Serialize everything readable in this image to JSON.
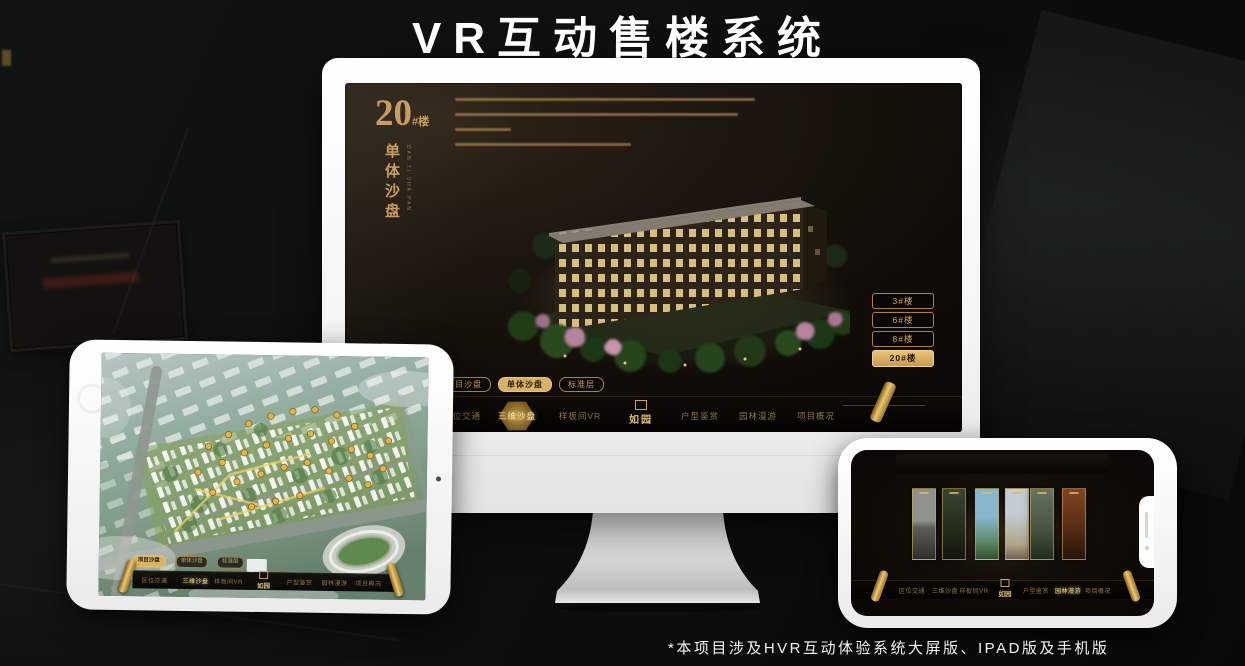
{
  "header": {
    "title": "VR互动售楼系统"
  },
  "footer": {
    "note": "*本项目涉及HVR互动体验系统大屏版、IPAD版及手机版"
  },
  "brand": {
    "logo_text": "如园"
  },
  "palette": {
    "gold": "#c9a05c",
    "gold_selected": "#d9b266",
    "screen_brown": "#1c1510",
    "device_white": "#f5f5f5"
  },
  "menu": {
    "items": [
      {
        "label": "区位交通"
      },
      {
        "label": "三维沙盘"
      },
      {
        "label": "样板间VR"
      },
      {
        "label": "户型鉴赏"
      },
      {
        "label": "园林漫游"
      },
      {
        "label": "项目概况"
      }
    ]
  },
  "monitor": {
    "screen_title": {
      "number": "20",
      "suffix": "#楼",
      "vertical": "单体沙盘",
      "vertical_en": "DAN TI SHA PAN"
    },
    "floor_buttons": [
      {
        "label": "3#楼",
        "selected": false
      },
      {
        "label": "6#楼",
        "selected": false
      },
      {
        "label": "8#楼",
        "selected": false
      },
      {
        "label": "20#楼",
        "selected": true
      }
    ],
    "view_tabs": [
      {
        "label": "项目沙盘",
        "selected": false
      },
      {
        "label": "单体沙盘",
        "selected": true
      },
      {
        "label": "标准层",
        "selected": false
      }
    ],
    "selected_menu": "三维沙盘"
  },
  "ipad": {
    "view_tabs": [
      {
        "label": "项目沙盘",
        "selected": true
      },
      {
        "label": "单体沙盘",
        "selected": false
      },
      {
        "label": "标准层",
        "selected": false
      }
    ],
    "selected_menu": "三维沙盘"
  },
  "phone": {
    "selected_menu": "园林漫游"
  }
}
